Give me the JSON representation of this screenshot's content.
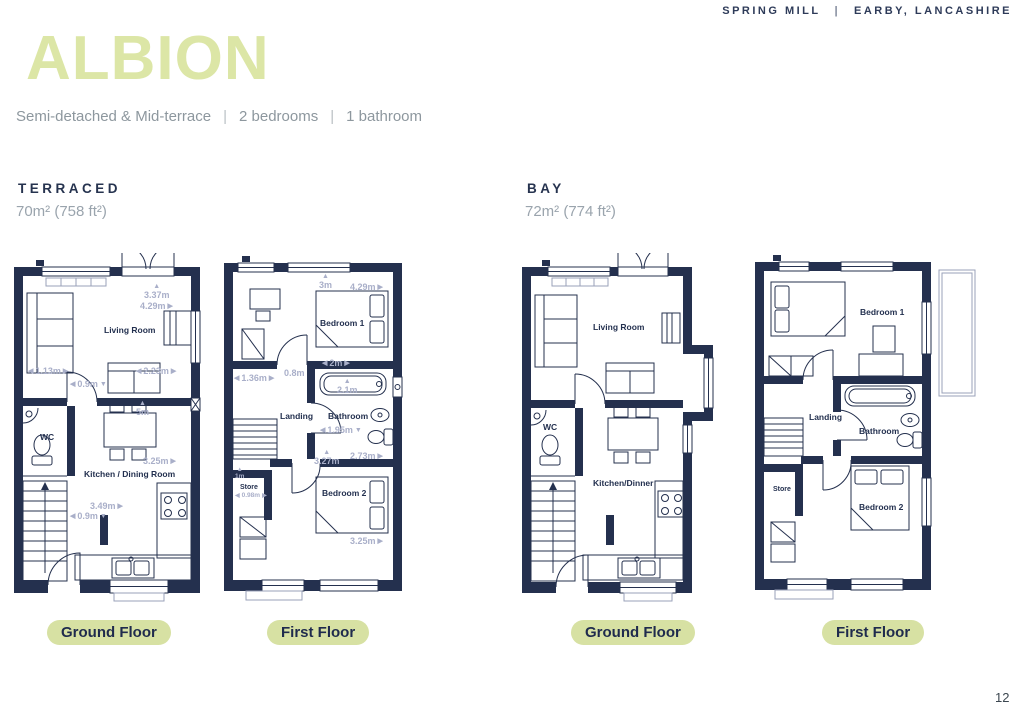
{
  "page": {
    "project": "SPRING MILL",
    "location": "EARBY, LANCASHIRE",
    "separator": "|",
    "title": "ALBION",
    "subtitle_type": "Semi-detached & Mid-terrace",
    "subtitle_beds": "2 bedrooms",
    "subtitle_baths": "1 bathroom",
    "page_number": "12"
  },
  "icons": {
    "arrow_left": "◀",
    "arrow_right": "▶",
    "arrow_up": "▲",
    "arrow_down": "▼"
  },
  "colors": {
    "accent_green": "#dce6a6",
    "pill_green": "#d7e1a3",
    "navy": "#24304e",
    "dim_label": "#a9afc9",
    "muted_text": "#8d979e"
  },
  "sections": {
    "terraced": {
      "name": "TERRACED",
      "area": "70m² (758 ft²)"
    },
    "bay": {
      "name": "BAY",
      "area": "72m² (774 ft²)"
    }
  },
  "plans": {
    "terraced_ground": {
      "floor_label": "Ground Floor",
      "rooms": {
        "living": "Living Room",
        "wc": "WC",
        "kitchen": "Kitchen / Dining Room"
      },
      "dims": {
        "d1": "3.37m",
        "d2": "4.29m",
        "d3": "1.13m",
        "d4": "0.9m",
        "d5": "2.23m",
        "d6": "5m",
        "d7": "3.25m",
        "d8": "3.49m",
        "d9": "0.9m"
      }
    },
    "terraced_first": {
      "floor_label": "First Floor",
      "rooms": {
        "bedroom1": "Bedroom 1",
        "landing": "Landing",
        "bathroom": "Bathroom",
        "store": "Store",
        "bedroom2": "Bedroom 2"
      },
      "dims": {
        "d1": "3m",
        "d2": "4.29m",
        "d3": "1.36m",
        "d4": "0.8m",
        "d5": "2m",
        "d6": "2.1m",
        "d7": "1.95m",
        "d8": "2.73m",
        "d9": "3.27m",
        "d10": "1m",
        "d11": "0.98m",
        "d12": "3.25m"
      }
    },
    "bay_ground": {
      "floor_label": "Ground Floor",
      "rooms": {
        "living": "Living Room",
        "wc": "WC",
        "kitchen": "Kitchen/Dinner"
      }
    },
    "bay_first": {
      "floor_label": "First Floor",
      "rooms": {
        "bedroom1": "Bedroom 1",
        "landing": "Landing",
        "bathroom": "Bathroom",
        "store": "Store",
        "bedroom2": "Bedroom 2"
      }
    }
  }
}
